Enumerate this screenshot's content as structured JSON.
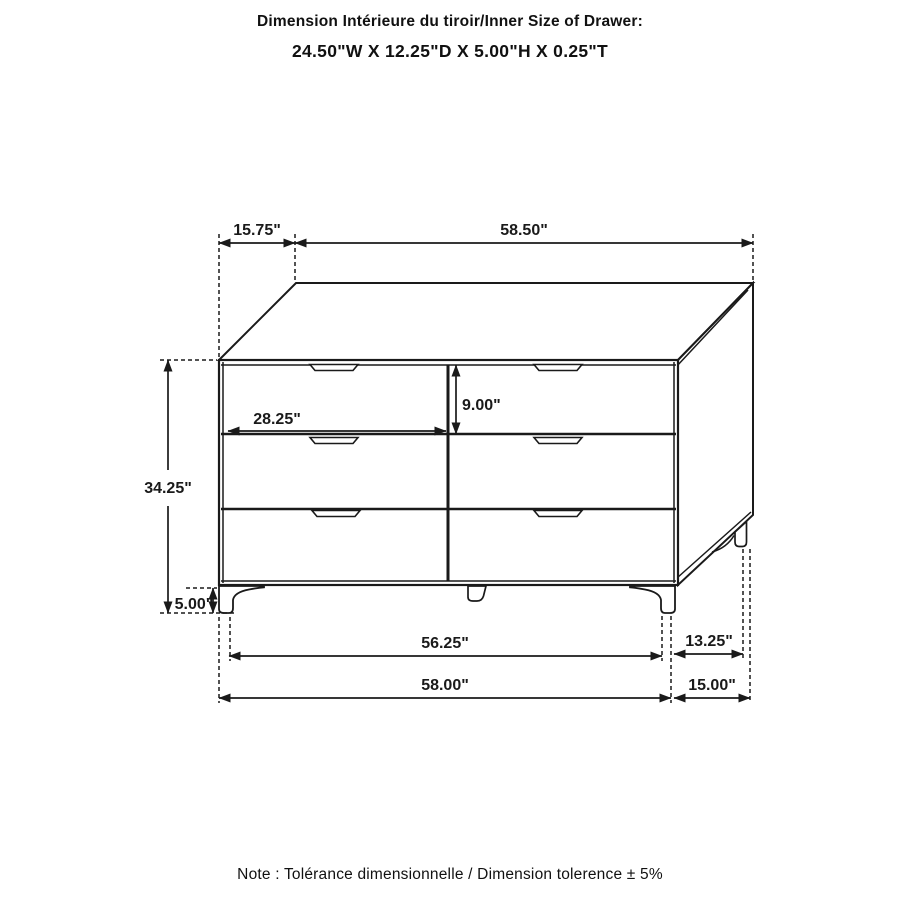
{
  "title": {
    "line1": "Dimension Intérieure du tiroir/Inner Size of Drawer:",
    "line2": "24.50\"W X 12.25\"D X 5.00\"H X 0.25\"T"
  },
  "note": "Note : Tolérance dimensionnelle / Dimension tolerence  ± 5%",
  "product": "6-drawer dresser dimension drawing",
  "dims": {
    "top_depth": "15.75\"",
    "top_width": "58.50\"",
    "overall_height": "34.25\"",
    "leg_height": "5.00\"",
    "drawer_front_width": "28.25\"",
    "drawer_front_height": "9.00\"",
    "front_leg_span": "56.25\"",
    "overall_width": "58.00\"",
    "side_leg_span": "13.25\"",
    "overall_depth": "15.00\""
  },
  "colors": {
    "line": "#1a1a1a",
    "background": "#ffffff"
  }
}
